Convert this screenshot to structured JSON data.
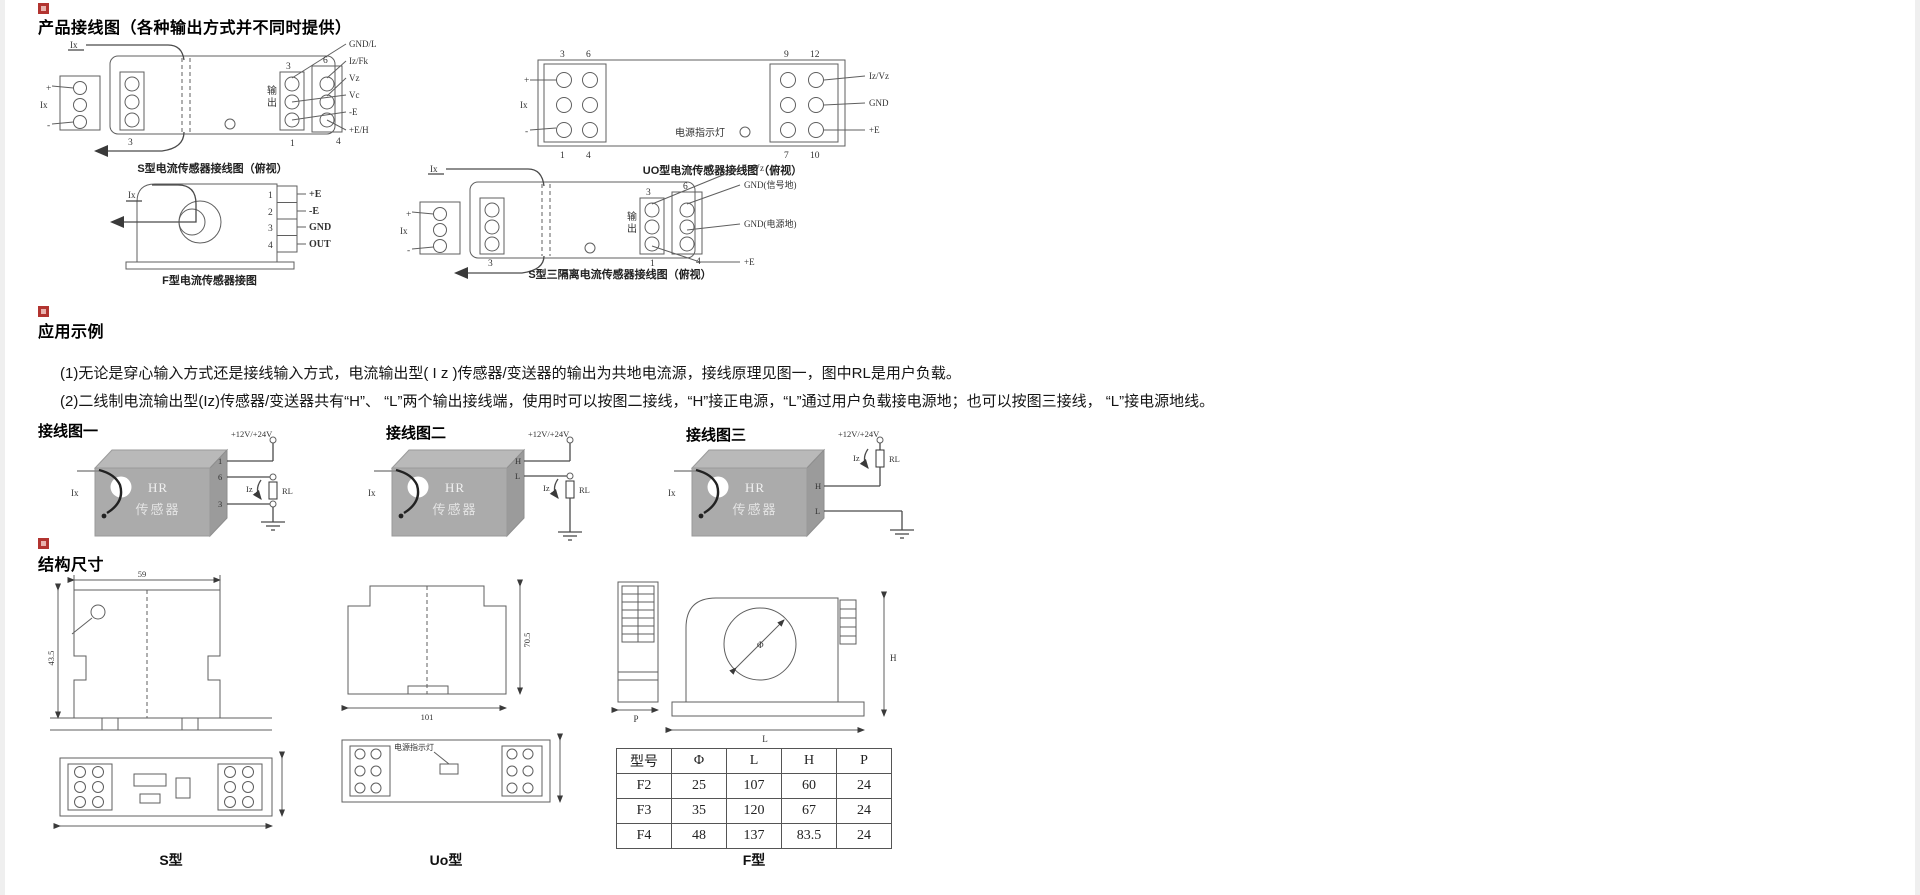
{
  "wiring_section": {
    "title": "产品接线图（各种输出方式并不同时提供）",
    "s_diagram": {
      "caption": "S型电流传感器接线图（俯视）",
      "input_top": "Ix",
      "input_side": "Ix",
      "plus": "+",
      "minus": "-",
      "output_label_1": "输",
      "output_label_2": "出",
      "num_left_bottom": "3",
      "num_inner_top": "3",
      "num_outer_top": "6",
      "num_inner_bottom": "1",
      "num_outer_bottom": "4",
      "pins": [
        "GND/L",
        "Iz/Fk",
        "Vz",
        "Vc",
        "-E",
        "+E/H"
      ]
    },
    "uo_diagram": {
      "caption": "UO型电流传感器接线图（俯视）",
      "input": "Ix",
      "plus": "+",
      "minus": "-",
      "indicator_label": "电源指示灯",
      "nums_left": [
        "3",
        "6",
        "1",
        "4"
      ],
      "nums_right": [
        "9",
        "12",
        "7",
        "10"
      ],
      "pins": [
        "Iz/Vz",
        "GND",
        "+E"
      ]
    },
    "f_diagram": {
      "caption": "F型电流传感器接图",
      "input": "Ix",
      "terminal_numbers": [
        "1",
        "2",
        "3",
        "4"
      ],
      "pins": [
        "+E",
        "-E",
        "GND",
        "OUT"
      ]
    },
    "s3_diagram": {
      "caption": "S型三隔离电流传感器接线图（俯视）",
      "input_top": "Ix",
      "input_side": "Ix",
      "plus": "+",
      "minus": "-",
      "output_label_1": "输",
      "output_label_2": "出",
      "num_left_bottom": "3",
      "num_inner_top": "3",
      "num_outer_top": "6",
      "num_inner_bottom": "1",
      "num_outer_bottom": "4",
      "pins": [
        "Iz/Vz",
        "GND(信号地)",
        "GND(电源地)",
        "+E"
      ]
    }
  },
  "application_section": {
    "title": "应用示例",
    "para1": "(1)无论是穿心输入方式还是接线输入方式，电流输出型( I z )传感器/变送器的输出为共地电流源，接线原理见图一，图中RL是用户负载。",
    "para2": "(2)二线制电流输出型(Iz)传感器/变送器共有“H”、 “L”两个输出接线端，使用时可以按图二接线，“H”接正电源，“L”通过用户负载接电源地；也可以按图三接线， “L”接电源地线。",
    "fig1": {
      "label": "接线图一",
      "power": "+12V/+24V",
      "device_top": "HR",
      "device_bottom": "传感器",
      "input": "Ix",
      "pin_a": "1",
      "pin_b": "6",
      "pin_c": "3",
      "current": "Iz",
      "load": "RL"
    },
    "fig2": {
      "label": "接线图二",
      "power": "+12V/+24V",
      "device_top": "HR",
      "device_bottom": "传感器",
      "input": "Ix",
      "pin_a": "H",
      "pin_b": "L",
      "current": "Iz",
      "load": "RL"
    },
    "fig3": {
      "label": "接线图三",
      "power": "+12V/+24V",
      "device_top": "HR",
      "device_bottom": "传感器",
      "input": "Ix",
      "pin_a": "H",
      "pin_b": "L",
      "current": "Iz",
      "load": "RL"
    }
  },
  "dimensions_section": {
    "title": "结构尺寸",
    "s_drawing": {
      "caption": "S型",
      "dim_width": "59",
      "dim_height": "43.5"
    },
    "uo_drawing": {
      "caption": "Uo型",
      "dim_height": "70.5",
      "dim_width": "101",
      "indicator": "电源指示灯"
    },
    "f_drawing": {
      "caption": "F型",
      "dim_phi": "Φ",
      "dim_h": "H",
      "dim_l": "L",
      "dim_p": "P"
    },
    "table": {
      "headers": [
        "型号",
        "Φ",
        "L",
        "H",
        "P"
      ],
      "rows": [
        [
          "F2",
          "25",
          "107",
          "60",
          "24"
        ],
        [
          "F3",
          "35",
          "120",
          "67",
          "24"
        ],
        [
          "F4",
          "48",
          "137",
          "83.5",
          "24"
        ]
      ]
    }
  }
}
